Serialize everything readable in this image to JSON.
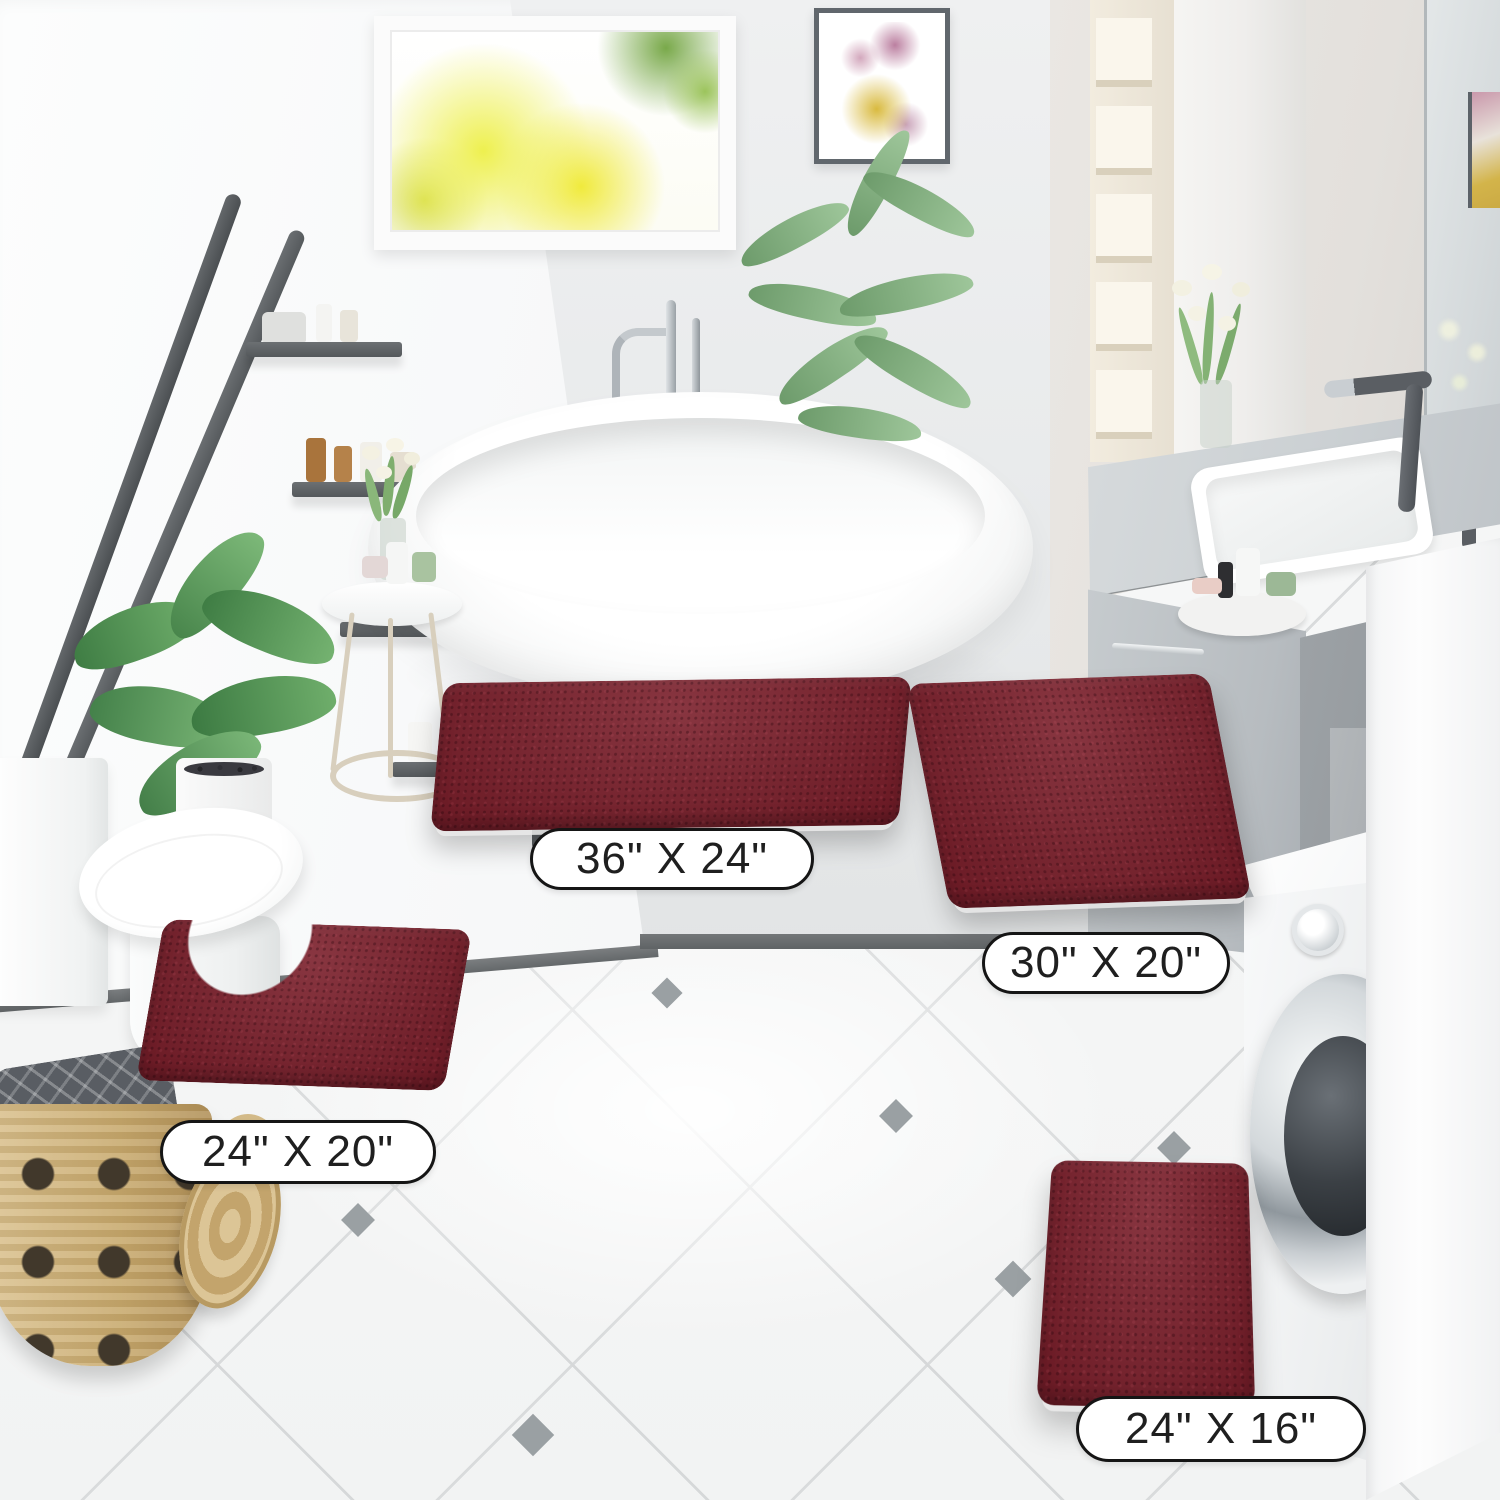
{
  "scene": {
    "type": "product-photo",
    "setting": "modern white bathroom with diagonal tile floor",
    "product": "chenille bath rug 4-piece set",
    "rug_color_name": "burgundy"
  },
  "rugs": [
    {
      "id": "rug-large",
      "shape": "rectangle",
      "size_label": "36\" X 24\""
    },
    {
      "id": "rug-medium",
      "shape": "rectangle",
      "size_label": "30\" X 20\""
    },
    {
      "id": "rug-contour",
      "shape": "u-shaped contour",
      "size_label": "24\" X 20\""
    },
    {
      "id": "rug-small",
      "shape": "rectangle",
      "size_label": "24\" X 16\""
    }
  ],
  "colors": {
    "rug": "#7b1f2b",
    "floor": "#f5f6f6",
    "tile_accent": "#9aa0a3",
    "wall": "#e9eaeb",
    "right_wall": "#e3e0dc",
    "vanity": "#c0c5c9",
    "ladder_shelf": "#54585b",
    "basket": "#c9ab70",
    "window_foliage_yellow": "#eef04f",
    "window_foliage_green": "#79a94a"
  },
  "objects": [
    "window with yellow autumn tree view",
    "abstract watercolor wall art",
    "dark gray ladder shelf with toiletries and towels",
    "freestanding oval bathtub",
    "chrome floor-mounted tub faucet",
    "areca palm plant",
    "green leafy plant in white pot",
    "round side table with toiletries and white flowers",
    "white toilet",
    "wicker laundry basket with gray towel and lid",
    "gray double vanity with white sink and dark faucet",
    "wall mirror with reflections",
    "tall cream storage shelf",
    "white front-load washing machine",
    "white side cabinet"
  ]
}
